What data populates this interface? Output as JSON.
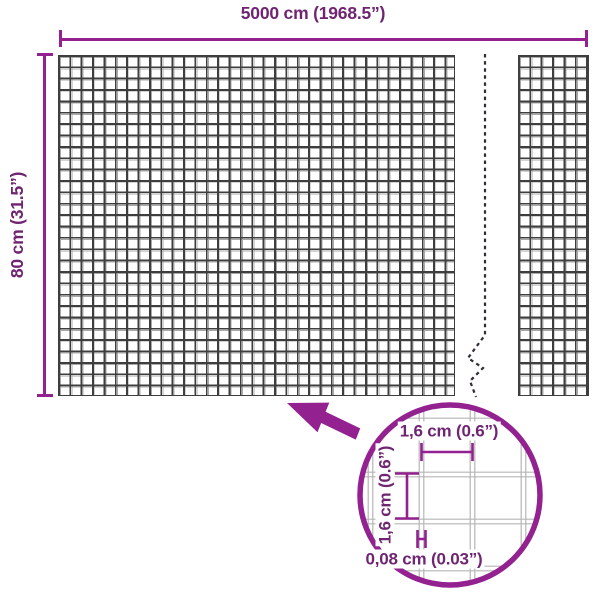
{
  "colors": {
    "accent": "#93218f",
    "label": "#6f2572",
    "mesh_dark": "#3e3e3e",
    "mesh_light": "#a9a9a9",
    "detail_grid": "#b5b5b5",
    "break_line": "#332b36"
  },
  "diagram": {
    "width_dimension": "5000 cm (1968.5”)",
    "height_dimension": "80 cm (31.5”)",
    "detail": {
      "mesh_opening_width": "1,6 cm (0.6”)",
      "mesh_opening_height": "1,6 cm (0.6”)",
      "wire_thickness": "0,08 cm (0.03”)"
    }
  }
}
